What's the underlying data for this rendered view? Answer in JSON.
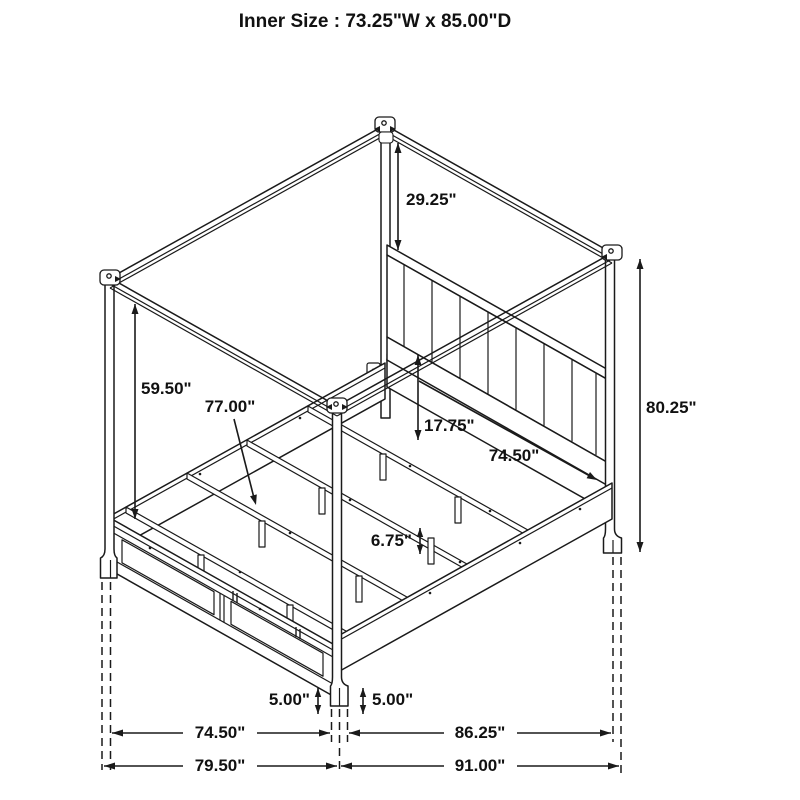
{
  "title": "Inner Size : 73.25\"W x 85.00\"D",
  "diagram_subject": "canopy-bed-dimension-drawing",
  "dims": {
    "canopy_to_headboard": "29.25\"",
    "under_canopy_clearance": "59.50\"",
    "slat_length": "77.00\"",
    "deck_to_headboard": "17.75\"",
    "side_rail_inner": "74.50\"",
    "overall_height": "80.25\"",
    "leg_height": "6.75\"",
    "foot_height_left": "5.00\"",
    "foot_height_right": "5.00\"",
    "front_width_inner": "74.50\"",
    "side_depth_inner": "86.25\"",
    "front_width_overall": "79.50\"",
    "side_depth_overall": "91.00\""
  }
}
